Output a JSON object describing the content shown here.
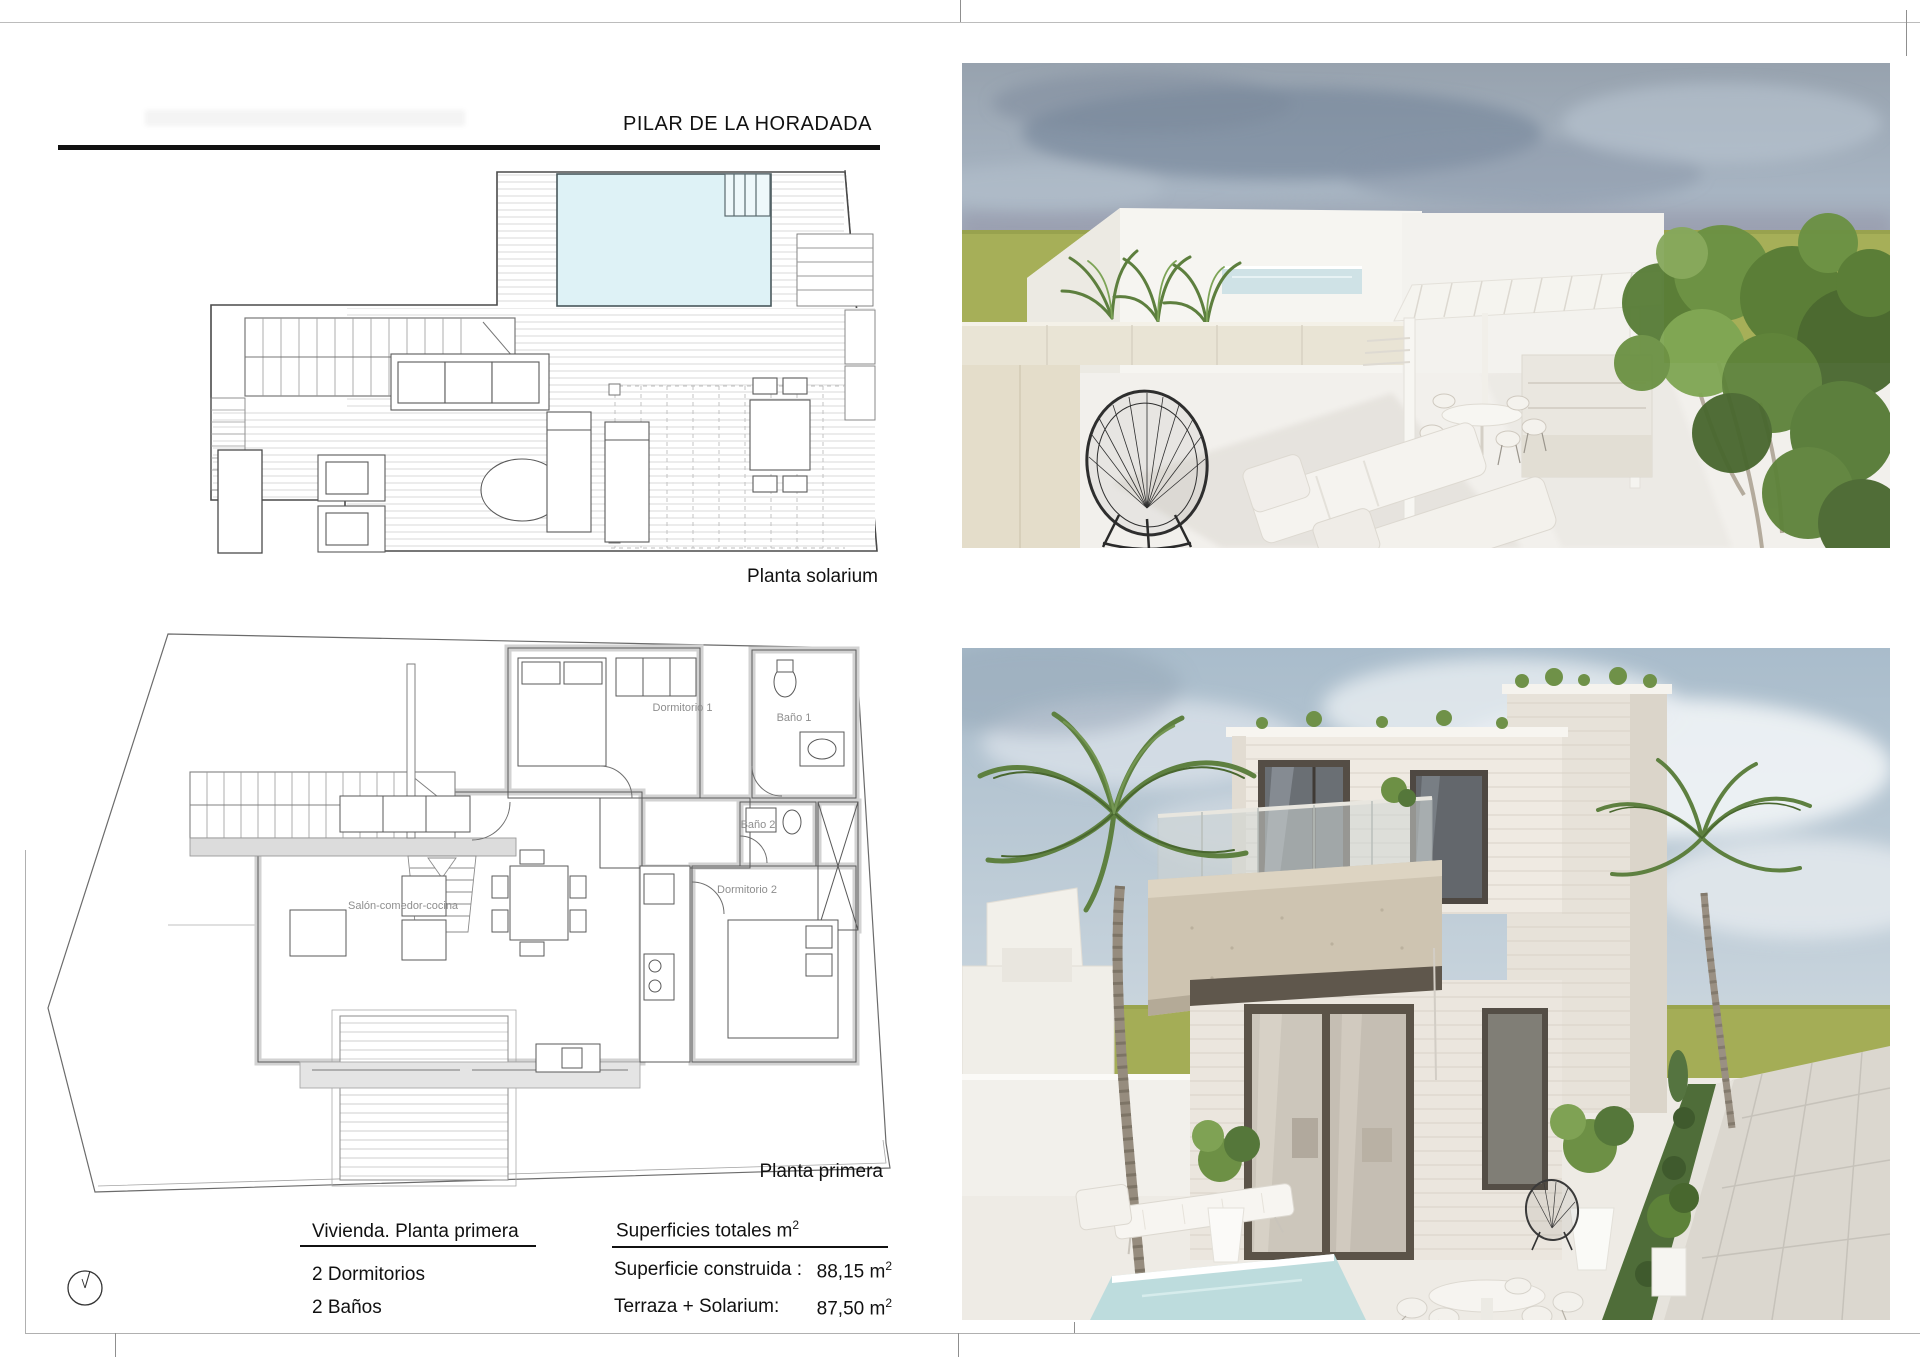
{
  "sheet": {
    "title": "PILAR DE LA HORADADA",
    "plan_labels": {
      "solarium": "Planta solarium",
      "first_floor": "Planta primera"
    },
    "rooms": {
      "dormitorio1": "Dormitorio 1",
      "bano1": "Baño 1",
      "bano2": "Baño 2",
      "dormitorio2": "Dormitorio 2",
      "salon": "Salón-comedor-cocina"
    },
    "info_left": {
      "heading": "Vivienda. Planta primera",
      "bedrooms": "2  Dormitorios",
      "baths": "2  Baños"
    },
    "info_right": {
      "heading": "Superficies totales m",
      "heading_sup": "2",
      "rows": [
        {
          "label": "Superficie construida :",
          "value": "88,15",
          "unit": "m",
          "unit_sup": "2"
        },
        {
          "label": "Terraza + Solarium:",
          "value": "87,50",
          "unit": "m",
          "unit_sup": "2"
        }
      ]
    },
    "icons": {
      "north_indicator": "north-indicator-icon"
    },
    "colors": {
      "pool_water": "#def2f6",
      "plan_wall_gray": "#d4d4d4",
      "plan_line": "#555555",
      "sky_top": "#97a2ae",
      "sky_bottom_photo2": "#ccd7df",
      "grass": "#a5ae58",
      "white_wall": "#f6f5f1",
      "stone_wall": "#ebe6de",
      "balcony_concrete": "#cec4b1",
      "window_frame": "#544d45",
      "foliage": "#5e8040",
      "wire_chair": "#2e2e2e",
      "beige_balustrade": "#e8e3d4"
    }
  }
}
